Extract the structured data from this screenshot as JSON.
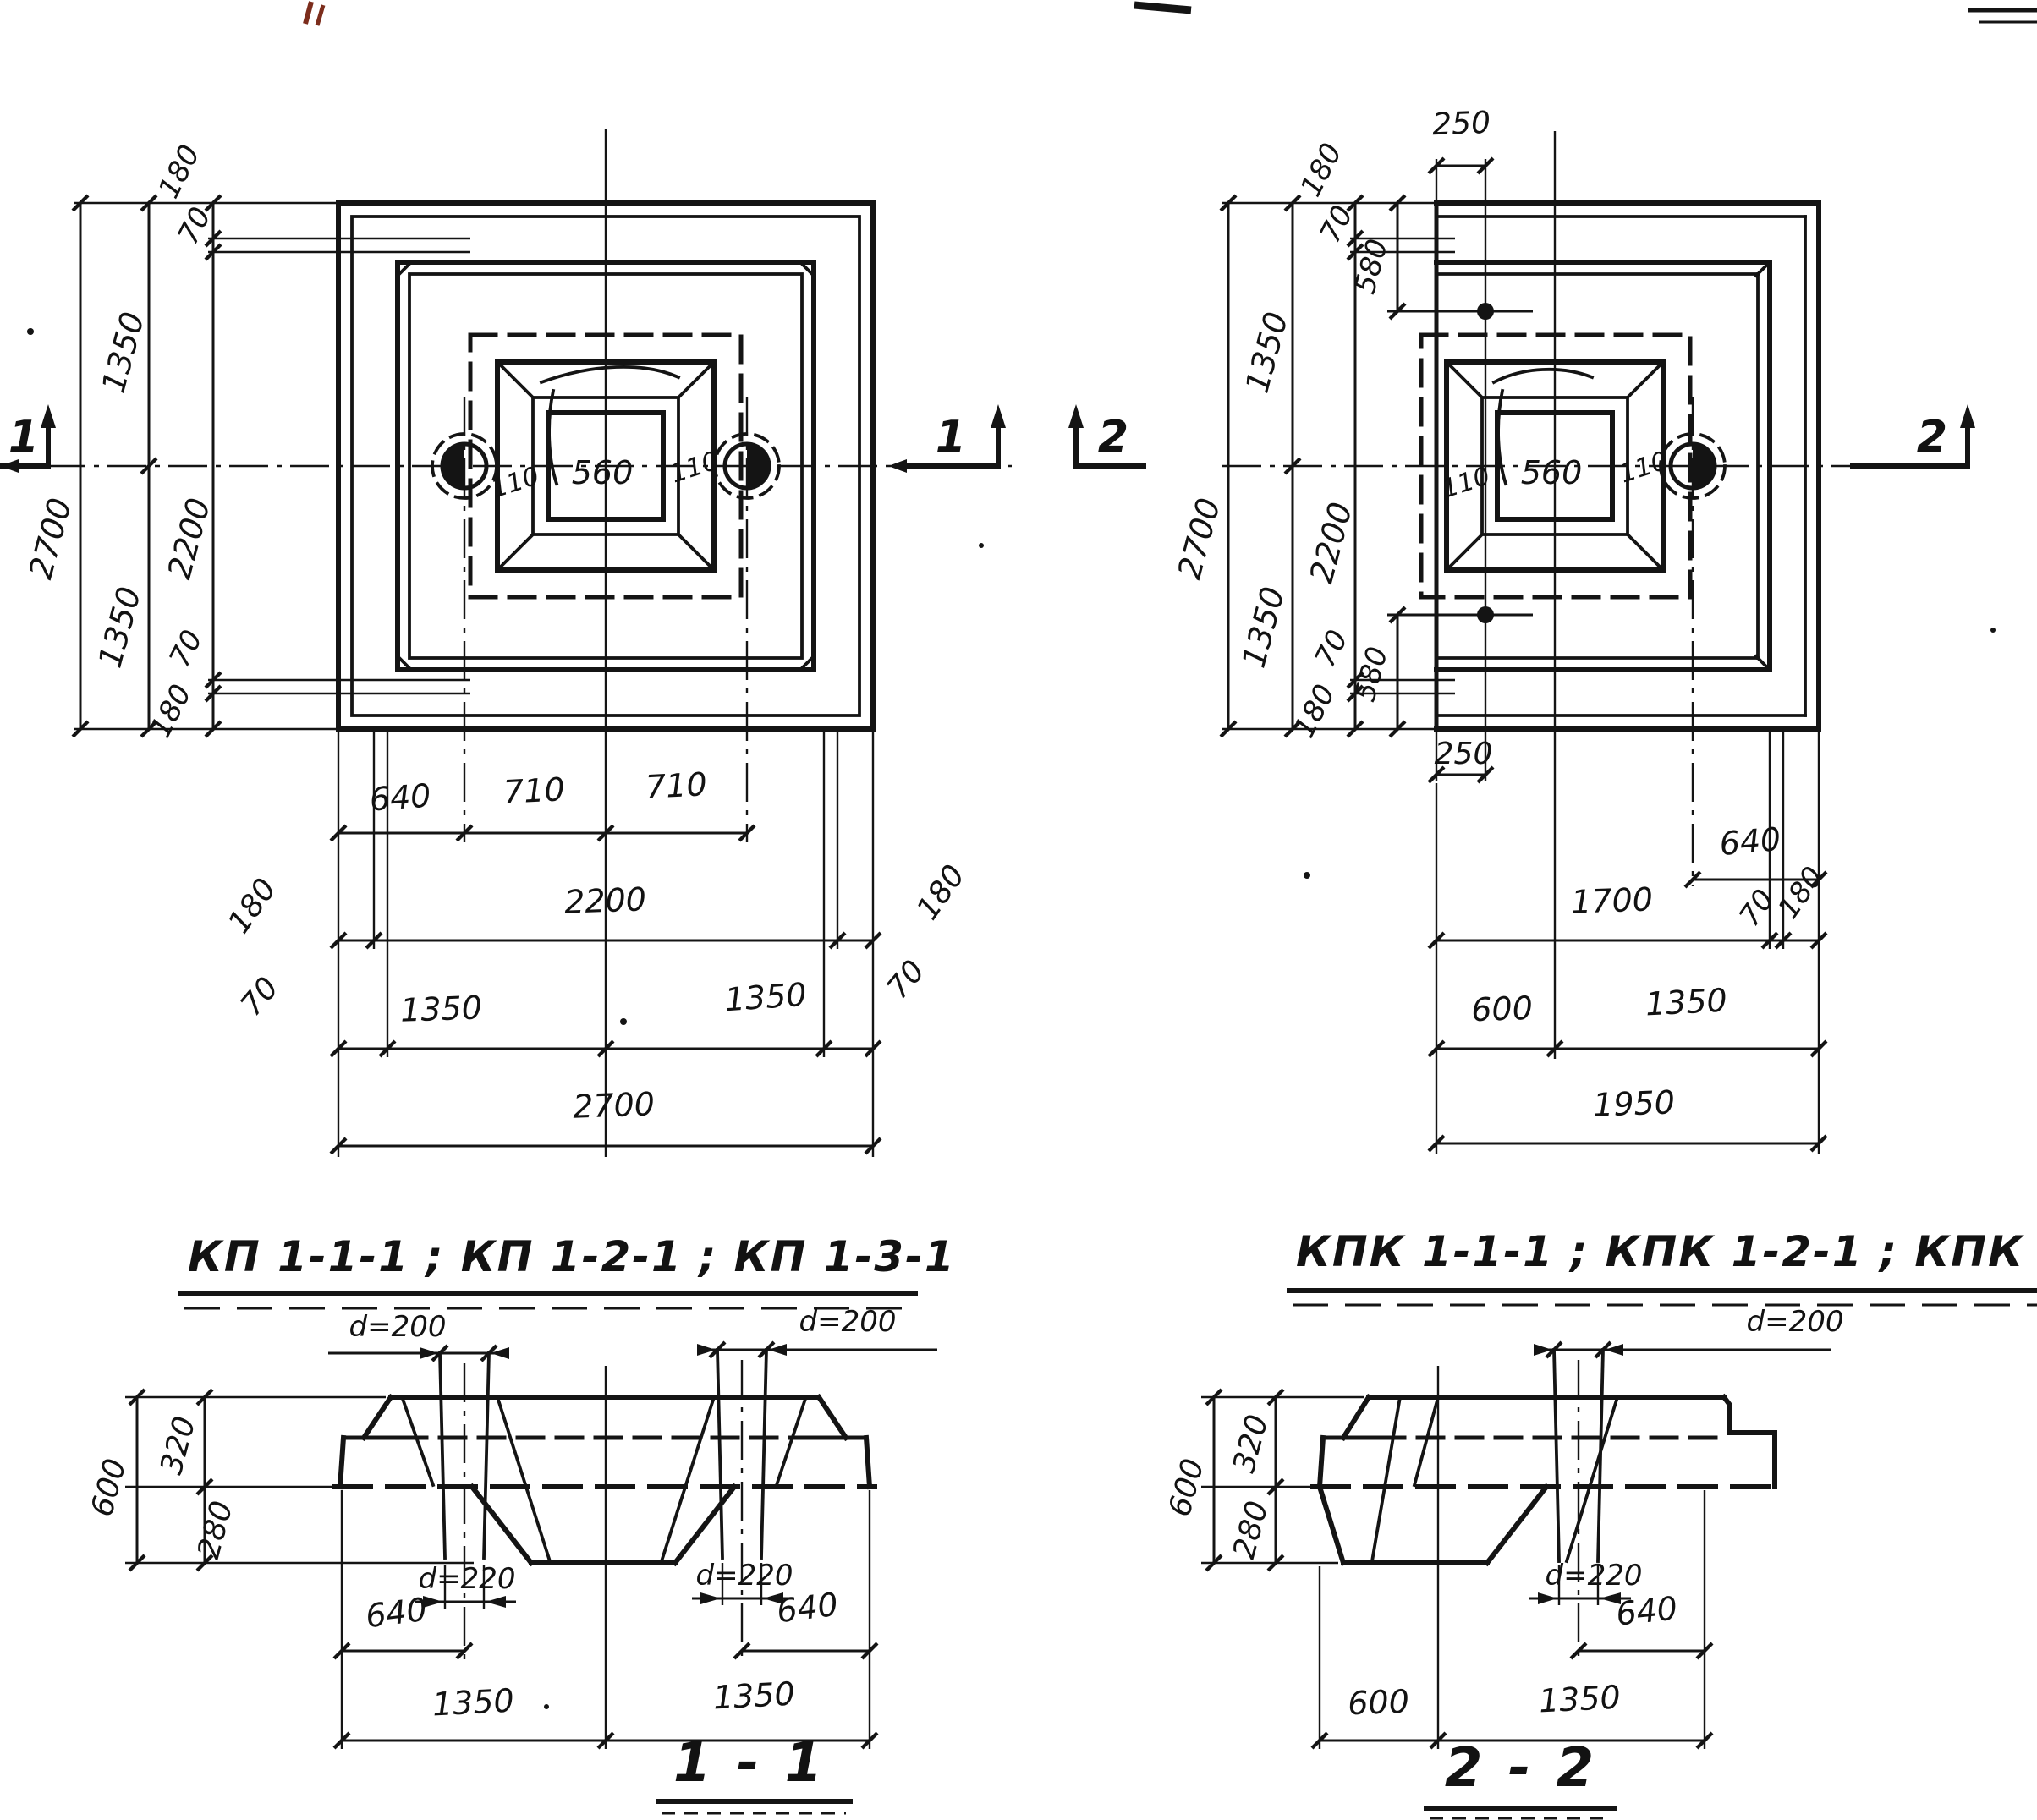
{
  "plan_left": {
    "marker": "1",
    "left_total": "2700",
    "left_half_top": "1350",
    "left_half_bottom": "1350",
    "left_inner": "2200",
    "left_edge_top": "180",
    "left_off_top": "70",
    "left_off_bottom": "70",
    "left_edge_bottom": "180",
    "bottom_row1": [
      "640",
      "710",
      "710"
    ],
    "bottom_row2": [
      "180",
      "2200",
      "180"
    ],
    "bottom_row3": [
      "70",
      "1350",
      "1350",
      "70"
    ],
    "bottom_total": "2700",
    "pocket_width": "560",
    "pocket_wall_left": "110",
    "pocket_wall_right": "110"
  },
  "plan_right": {
    "marker": "2",
    "left_total": "2700",
    "left_half_top": "1350",
    "left_half_bottom": "1350",
    "left_inner": "2200",
    "edge_top": "180",
    "off_top": "70",
    "anchor_top": "580",
    "off_bottom": "70",
    "edge_bottom": "180",
    "anchor_bottom": "580",
    "anchor_offset_top": "250",
    "anchor_offset_bottom": "250",
    "pile_offset": "640",
    "bottom_row2": [
      "1700",
      "70",
      "180"
    ],
    "bottom_row3": [
      "600",
      "1350"
    ],
    "bottom_total": "1950",
    "pocket_width": "560",
    "pocket_wall_left": "110",
    "pocket_wall_right": "110"
  },
  "titles": {
    "plan_left": "КП 1-1-1 ; КП 1-2-1 ; КП 1-3-1",
    "plan_right": "КПК 1-1-1 ; КПК 1-2-1 ; КПК 1-3-1",
    "section_left": "1 - 1",
    "section_right": "2 - 2"
  },
  "section_left": {
    "total_height": "600",
    "upper": "320",
    "lower": "280",
    "pile_dia_left": "d=200",
    "pile_dia_right": "d=200",
    "hole_dia_left": "d=220",
    "hole_dia_right": "d=220",
    "pile_edge_left": "640",
    "pile_edge_right": "640",
    "half_left": "1350",
    "half_right": "1350"
  },
  "section_right": {
    "total_height": "600",
    "upper": "320",
    "lower": "280",
    "pile_dia": "d=200",
    "hole_dia": "d=220",
    "pile_edge": "640",
    "left_part": "600",
    "right_part": "1350"
  }
}
